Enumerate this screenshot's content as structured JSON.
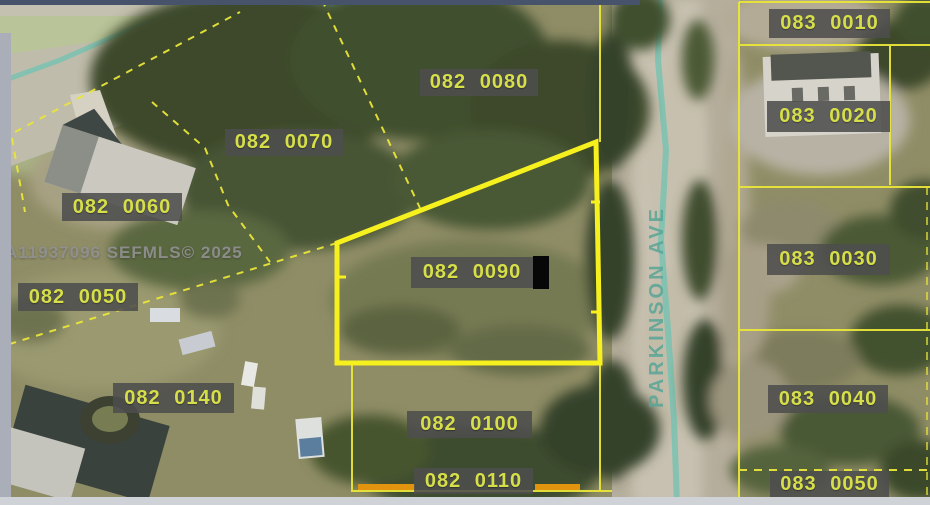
{
  "map": {
    "watermark": "A11937096 SEFMLS© 2025",
    "street_name": "PARKINSON AVE",
    "highlighted_parcel": "082 0090",
    "parcel_labels": [
      {
        "text": "082 0080",
        "x": 420,
        "y": 69,
        "w": 118,
        "h": 27
      },
      {
        "text": "082 0070",
        "x": 225,
        "y": 129,
        "w": 118,
        "h": 27
      },
      {
        "text": "082 0060",
        "x": 62,
        "y": 193,
        "w": 120,
        "h": 28
      },
      {
        "text": "082 0050",
        "x": 18,
        "y": 283,
        "w": 120,
        "h": 28
      },
      {
        "text": "082 0090",
        "x": 411,
        "y": 257,
        "w": 122,
        "h": 31,
        "cursor": true
      },
      {
        "text": "082 0140",
        "x": 113,
        "y": 383,
        "w": 121,
        "h": 30
      },
      {
        "text": "082 0100",
        "x": 407,
        "y": 411,
        "w": 125,
        "h": 27
      },
      {
        "text": "082 0110",
        "x": 414,
        "y": 468,
        "w": 119,
        "h": 26
      },
      {
        "text": "083 0010",
        "x": 769,
        "y": 9,
        "w": 121,
        "h": 29
      },
      {
        "text": "083 0020",
        "x": 767,
        "y": 101,
        "w": 123,
        "h": 31
      },
      {
        "text": "083 0030",
        "x": 767,
        "y": 244,
        "w": 123,
        "h": 31
      },
      {
        "text": "083 0040",
        "x": 768,
        "y": 385,
        "w": 120,
        "h": 28
      },
      {
        "text": "083 0050",
        "x": 770,
        "y": 471,
        "w": 119,
        "h": 27
      }
    ],
    "colors": {
      "parcel_line": "#e9e53a",
      "highlight_line": "#f6f01e",
      "orange_line": "#e2940f",
      "label_text": "#d6df4a",
      "label_bg": "#4d4d4d",
      "street_text": "#58a496",
      "road_centerline": "#79c2b2"
    }
  }
}
